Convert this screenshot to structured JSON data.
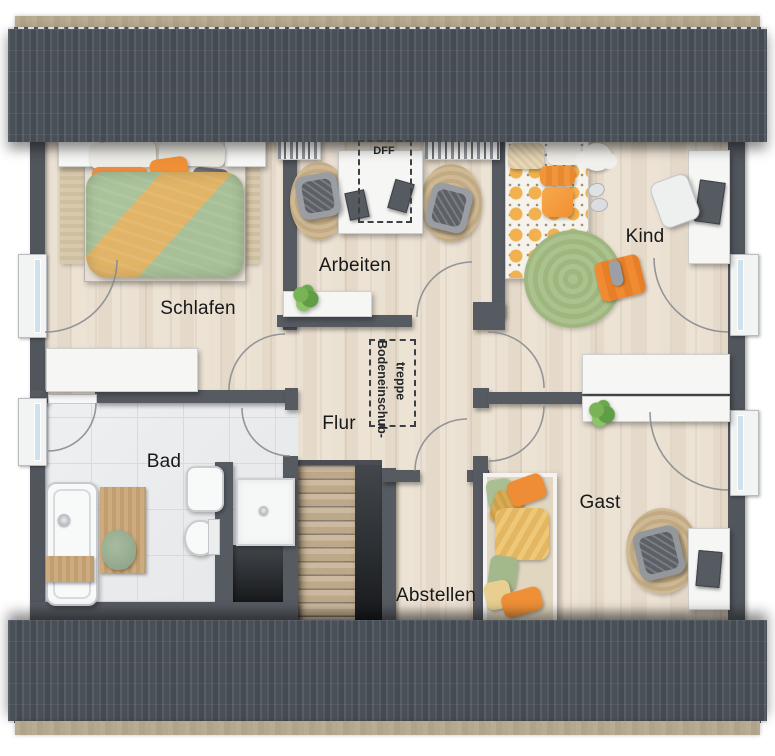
{
  "plan": {
    "title": "Dachgeschoss Grundriss",
    "rooms": {
      "schlafen": {
        "label": "Schlafen"
      },
      "arbeiten": {
        "label": "Arbeiten"
      },
      "kind": {
        "label": "Kind"
      },
      "flur": {
        "label": "Flur"
      },
      "bad": {
        "label": "Bad"
      },
      "abstellen": {
        "label": "Abstellen"
      },
      "gast": {
        "label": "Gast"
      }
    },
    "annotations": {
      "roof_window": {
        "label": "DFF"
      },
      "attic_ladder": {
        "line1": "Bodeneinschub-",
        "line2": "treppe"
      }
    },
    "colors": {
      "roof": "#4d535b",
      "gutter": "#b3a78e",
      "wall": "#565a61",
      "wood_floor": "#e7dccd",
      "tile_floor": "#e9ebed",
      "label_text": "#17181a",
      "accent_orange": "#ef8c36",
      "accent_mustard": "#d9a64b",
      "accent_green": "#a9c08d",
      "window_glass": "#cfe2ec"
    }
  }
}
